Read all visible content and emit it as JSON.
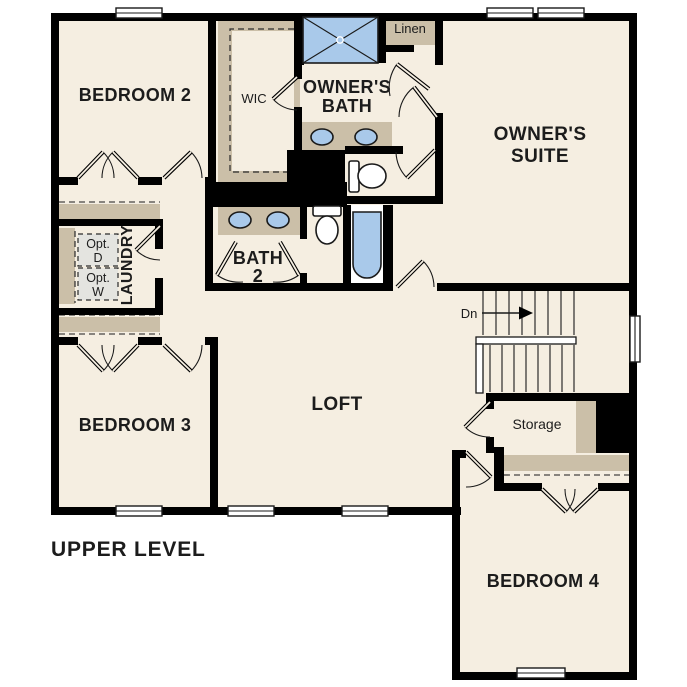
{
  "title": "UPPER LEVEL",
  "rooms": {
    "bedroom2": "BEDROOM 2",
    "bedroom3": "BEDROOM 3",
    "bedroom4": "BEDROOM 4",
    "owners_suite": [
      "OWNER'S",
      "SUITE"
    ],
    "owners_bath": [
      "OWNER'S",
      "BATH"
    ],
    "bath2": [
      "BATH",
      "2"
    ],
    "loft": "LOFT",
    "laundry": "LAUNDRY",
    "wic": "WIC",
    "linen": "Linen",
    "storage": "Storage",
    "opt_dryer": [
      "Opt.",
      "D"
    ],
    "opt_washer": [
      "Opt.",
      "W"
    ],
    "stairs_down": "Dn"
  },
  "colors": {
    "background": "#ffffff",
    "floor": "#f5eee1",
    "wall": "#000000",
    "cabinet_tan": "#cbbfa8",
    "fixture_blue": "#a9c9ea",
    "appliance_gray": "#e4e4e0",
    "text": "#1c1c1c"
  }
}
